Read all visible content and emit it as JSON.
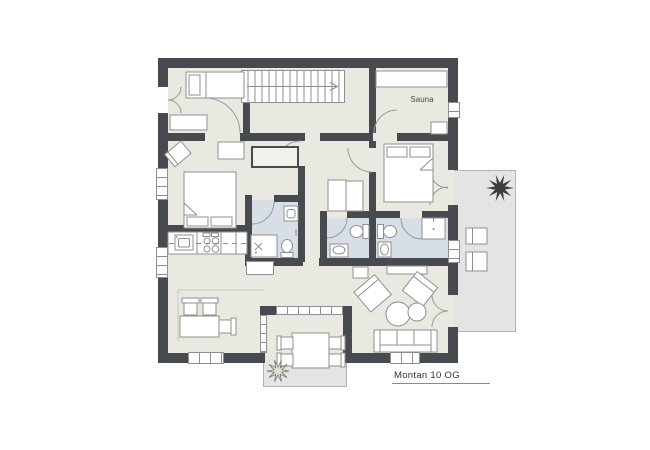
{
  "labels": {
    "sauna_room": "Sauna",
    "plan_title": "Montan 10 OG"
  },
  "icons": {
    "plant_icon": "spiky-plant-star",
    "stairs_direction_arrow_icon": "→"
  },
  "palette": {
    "page_bg": "#ffffff",
    "wall": "#474b50",
    "floor": "#e9e9e1",
    "bathroom_floor": "#d8dee6",
    "outdoor_floor": "#e4e4e4",
    "outdoor_border": "#b2b2b2",
    "line": "#8f8f8f",
    "furniture_fill": "#ffffff",
    "plant_dark": "#3b3e41",
    "text": "#333333",
    "label_muted": "#4a4a4a"
  }
}
